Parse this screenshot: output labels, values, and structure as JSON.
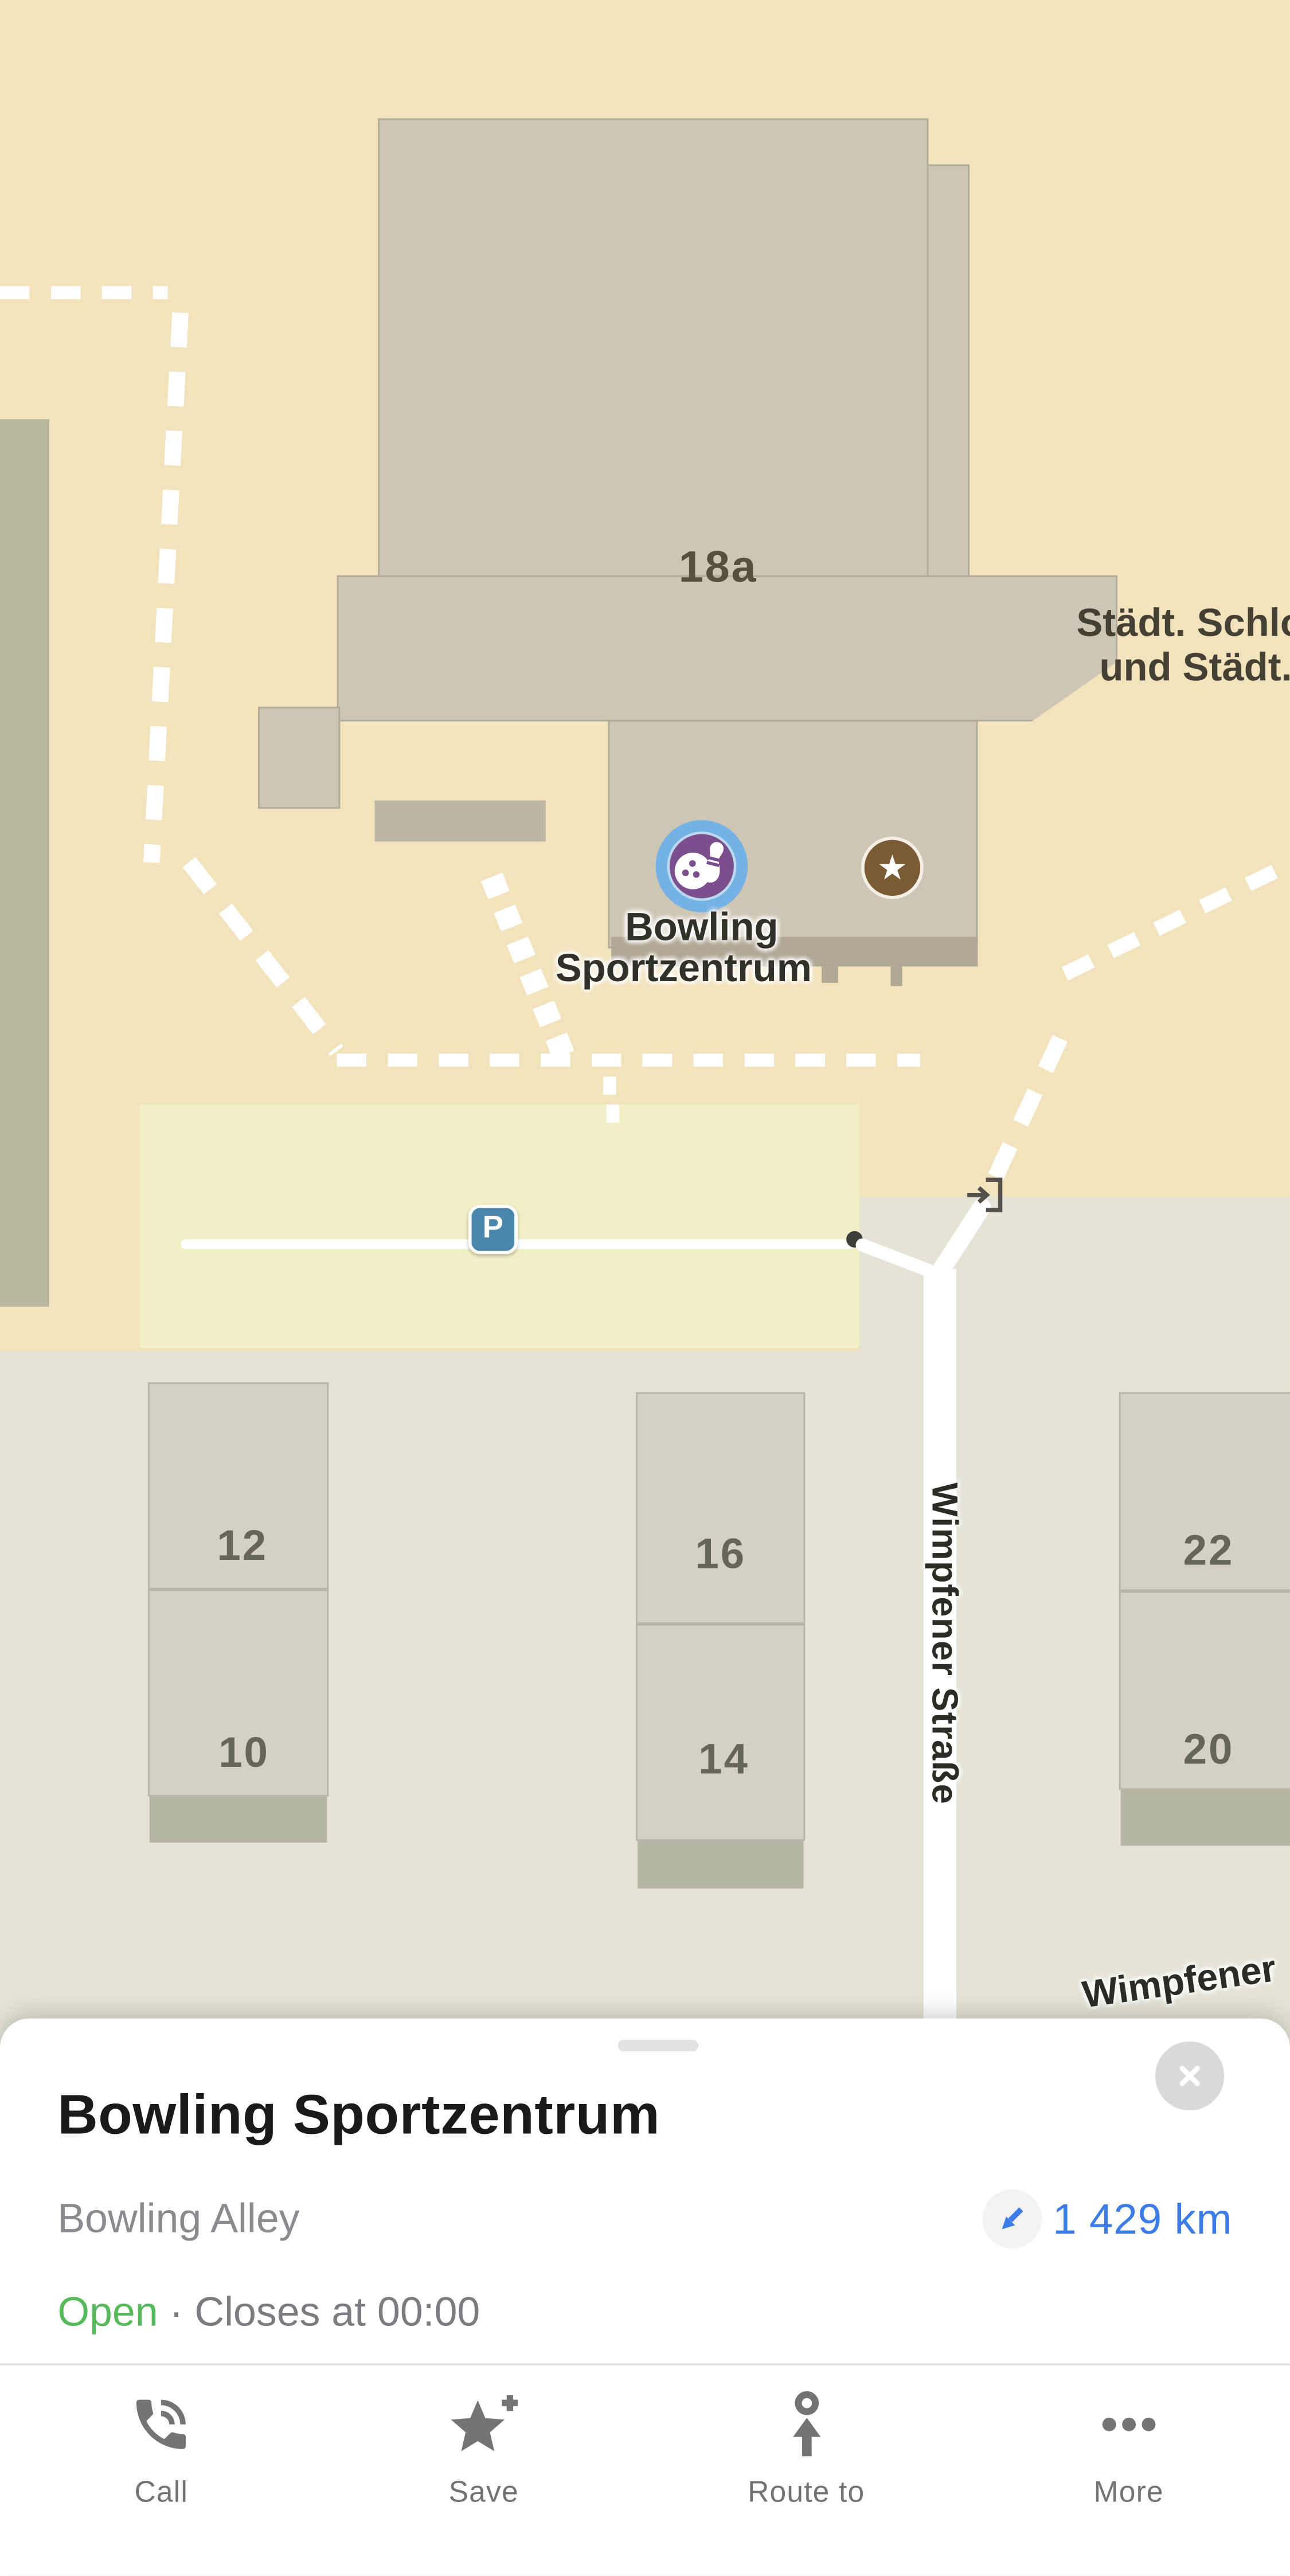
{
  "map": {
    "building_number": "18a",
    "truncated_place_line1": "Städt. Schlo",
    "truncated_place_line2": "und Städt.",
    "poi_label_line1": "Bowling",
    "poi_label_line2": "Sportzentrum",
    "parking_label": "P",
    "street_vertical": "Wimpfener Straße",
    "street_bottom_cut": "Wimpfener",
    "star_glyph": "★",
    "house_numbers": [
      "12",
      "10",
      "16",
      "14",
      "22",
      "20"
    ]
  },
  "sheet": {
    "title": "Bowling Sportzentrum",
    "category": "Bowling Alley",
    "distance": "1 429 km",
    "open_status": "Open",
    "separator": "·",
    "hours": "Closes at 00:00",
    "actions": [
      {
        "id": "call",
        "label": "Call"
      },
      {
        "id": "save",
        "label": "Save"
      },
      {
        "id": "route",
        "label": "Route to"
      },
      {
        "id": "more",
        "label": "More"
      }
    ]
  },
  "colors": {
    "map_background": "#F3E3BC",
    "map_lower_gray": "#E4E3D6",
    "building_fill": "#CDC6B5",
    "parking_area": "#F1EFC5",
    "parking_badge_blue": "#4A86AC",
    "marker_outer_blue": "#74B2E5",
    "marker_inner_purple": "#7B4E8E",
    "star_badge_brown": "#7B5B34",
    "distance_blue": "#3B7CE8",
    "open_green": "#56BA5B",
    "action_gray": "#747474"
  }
}
